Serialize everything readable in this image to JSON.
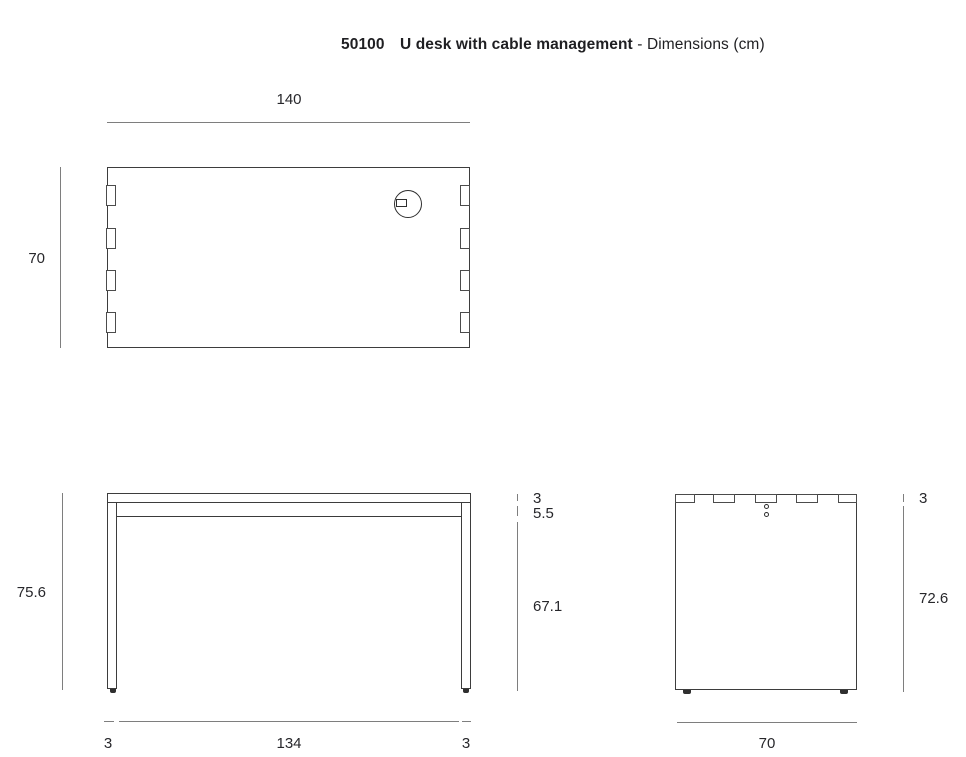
{
  "title": {
    "product_code": "50100",
    "product_name": "U desk with cable management",
    "separator": "-",
    "subtitle": "Dimensions (cm)"
  },
  "units": "cm",
  "colors": {
    "background": "#ffffff",
    "outline": "#3d3d3d",
    "dimension_line": "#7e7e7e",
    "text": "#27272b"
  },
  "top_view": {
    "width_label": "140",
    "depth_label": "70"
  },
  "front_view": {
    "total_height_label": "75.6",
    "top_thickness_label": "3",
    "frame_depth_label": "5.5",
    "clearance_label": "67.1",
    "left_leg_label": "3",
    "inner_span_label": "134",
    "right_leg_label": "3"
  },
  "side_view": {
    "top_thickness_label": "3",
    "under_top_height_label": "72.6",
    "depth_label": "70"
  }
}
